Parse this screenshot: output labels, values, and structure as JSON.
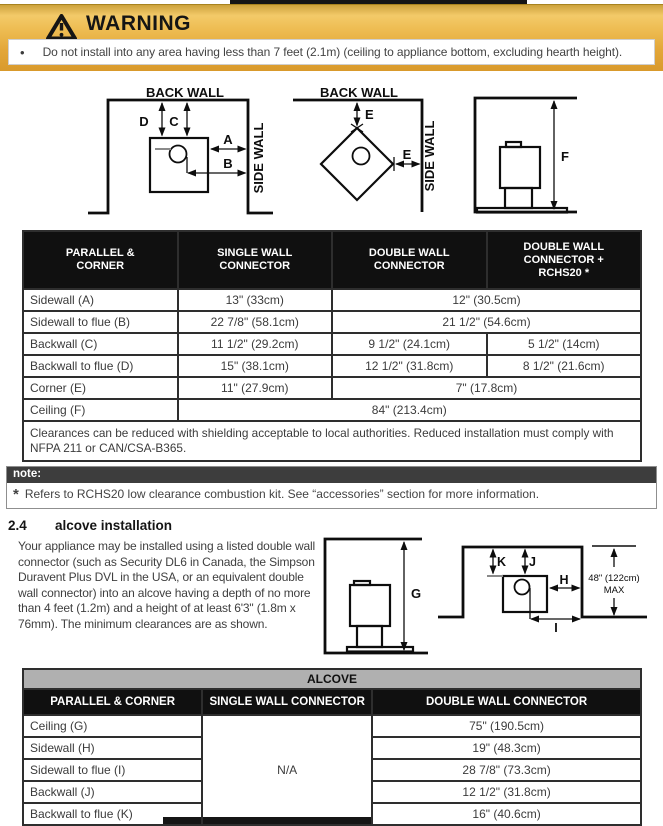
{
  "warning": {
    "title": "WARNING",
    "bullet": "•",
    "bullet_text": "Do not install into any area having less than 7 feet (2.1m) (ceiling to appliance bottom, excluding hearth height)."
  },
  "diagrams": {
    "back_wall": "BACK WALL",
    "side_wall": "SIDE WALL",
    "dim_a": "A",
    "dim_b": "B",
    "dim_c": "C",
    "dim_d": "D",
    "dim_e": "E",
    "dim_f": "F",
    "dim_g": "G",
    "dim_h": "H",
    "dim_i": "I",
    "dim_j": "J",
    "dim_k": "K",
    "max_line1": "48\" (122cm)",
    "max_line2": "MAX"
  },
  "clearance_table": {
    "headers": [
      "PARALLEL & CORNER",
      "SINGLE WALL CONNECTOR",
      "DOUBLE WALL CONNECTOR",
      "DOUBLE WALL CONNECTOR + RCHS20 *"
    ],
    "rows": [
      {
        "label": "Sidewall (A)",
        "cells": [
          {
            "text": "13\" (33cm)",
            "span": 1
          },
          {
            "text": "12\" (30.5cm)",
            "span": 2
          }
        ]
      },
      {
        "label": "Sidewall to flue (B)",
        "cells": [
          {
            "text": "22 7/8\" (58.1cm)",
            "span": 1
          },
          {
            "text": "21 1/2\" (54.6cm)",
            "span": 2
          }
        ]
      },
      {
        "label": "Backwall (C)",
        "cells": [
          {
            "text": "11 1/2\" (29.2cm)",
            "span": 1
          },
          {
            "text": "9 1/2\" (24.1cm)",
            "span": 1
          },
          {
            "text": "5 1/2\" (14cm)",
            "span": 1
          }
        ]
      },
      {
        "label": "Backwall to flue (D)",
        "cells": [
          {
            "text": "15\" (38.1cm)",
            "span": 1
          },
          {
            "text": "12 1/2\" (31.8cm)",
            "span": 1
          },
          {
            "text": "8 1/2\" (21.6cm)",
            "span": 1
          }
        ]
      },
      {
        "label": "Corner (E)",
        "cells": [
          {
            "text": "11\" (27.9cm)",
            "span": 1
          },
          {
            "text": "7\" (17.8cm)",
            "span": 2
          }
        ]
      },
      {
        "label": "Ceiling (F)",
        "cells": [
          {
            "text": "84\" (213.4cm)",
            "span": 3
          }
        ]
      }
    ],
    "footnote": "Clearances can be reduced with shielding acceptable to local authorities. Reduced installation must comply with NFPA 211 or CAN/CSA-B365."
  },
  "note": {
    "label": "note:",
    "marker": "*",
    "text": "Refers to RCHS20 low clearance combustion kit. See “accessories” section for more information."
  },
  "section": {
    "number": "2.4",
    "title": "alcove installation",
    "body": "Your appliance may be installed using a listed double wall connector (such as Security DL6 in Canada, the Simpson Duravent Plus DVL in the USA, or an equivalent double wall connector) into an alcove having a depth of no more than 4 feet (1.2m) and a height of at least 6'3\" (1.8m x 76mm). The minimum clearances are as shown."
  },
  "alcove_table": {
    "title": "ALCOVE",
    "headers": [
      "PARALLEL & CORNER",
      "SINGLE WALL CONNECTOR",
      "DOUBLE WALL CONNECTOR"
    ],
    "na": "N/A",
    "rows": [
      {
        "label": "Ceiling (G)",
        "value": "75\" (190.5cm)"
      },
      {
        "label": "Sidewall (H)",
        "value": "19\" (48.3cm)"
      },
      {
        "label": "Sidewall to flue (I)",
        "value": "28 7/8\" (73.3cm)"
      },
      {
        "label": "Backwall (J)",
        "value": "12 1/2\" (31.8cm)"
      },
      {
        "label": "Backwall to flue (K)",
        "value": "16\" (40.6cm)"
      }
    ]
  },
  "colors": {
    "banner_gold": "#e9b544",
    "table_header_bg": "#101010",
    "note_bar_bg": "#3d3d3d",
    "alcove_bar_bg": "#b0b0b0",
    "body_text": "#3b3b3b"
  }
}
